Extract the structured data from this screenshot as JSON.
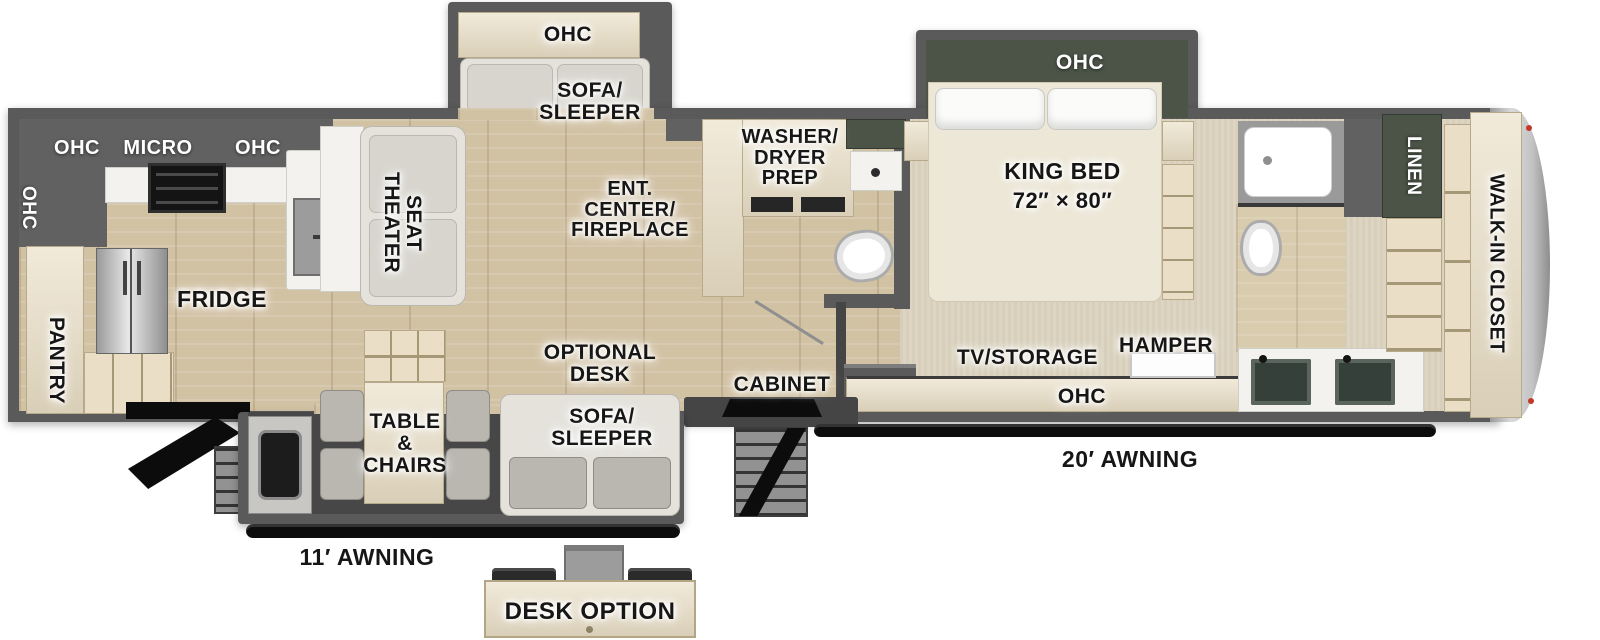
{
  "colors": {
    "wall": "#5a5a5a",
    "slide_accent_green": "#4b5447",
    "floor_wood": "#d2c2a4",
    "carpet": "#dcd4c0",
    "cabinet_wood": "#eadfc6",
    "awning_black": "#0d0d0d",
    "nose_cap_gray": "#c6c6c6",
    "label_black": "#161616",
    "label_white": "#ffffff"
  },
  "zones": {
    "kitchen": {
      "ohc_rear": "OHC",
      "ohc_left": "OHC",
      "micro": "MICRO",
      "ohc_right": "OHC",
      "pantry": "PANTRY",
      "fridge": "FRIDGE"
    },
    "living": {
      "theater_seat": "THEATER\nSEAT",
      "slide_ohc": "OHC",
      "slide_sofa": "SOFA/\nSLEEPER",
      "ent_center": "ENT.\nCENTER/\nFIREPLACE",
      "optional_desk": "OPTIONAL\nDESK",
      "rear_sofa": "SOFA/\nSLEEPER",
      "table_chairs": "TABLE\n&\nCHAIRS",
      "cabinet": "CABINET"
    },
    "bath_mid": {
      "washer_dryer": "WASHER/\nDRYER\nPREP"
    },
    "bedroom": {
      "ohc_slide": "OHC",
      "king_bed": "KING BED",
      "king_bed_size": "72″ × 80″",
      "tv_storage": "TV/STORAGE",
      "hamper": "HAMPER",
      "ohc": "OHC"
    },
    "bath_front": {
      "linen": "LINEN"
    },
    "closet": {
      "walk_in": "WALK-IN CLOSET"
    },
    "exterior": {
      "awning_rear": "11′ AWNING",
      "awning_main": "20′ AWNING",
      "desk_option": "DESK OPTION"
    }
  }
}
